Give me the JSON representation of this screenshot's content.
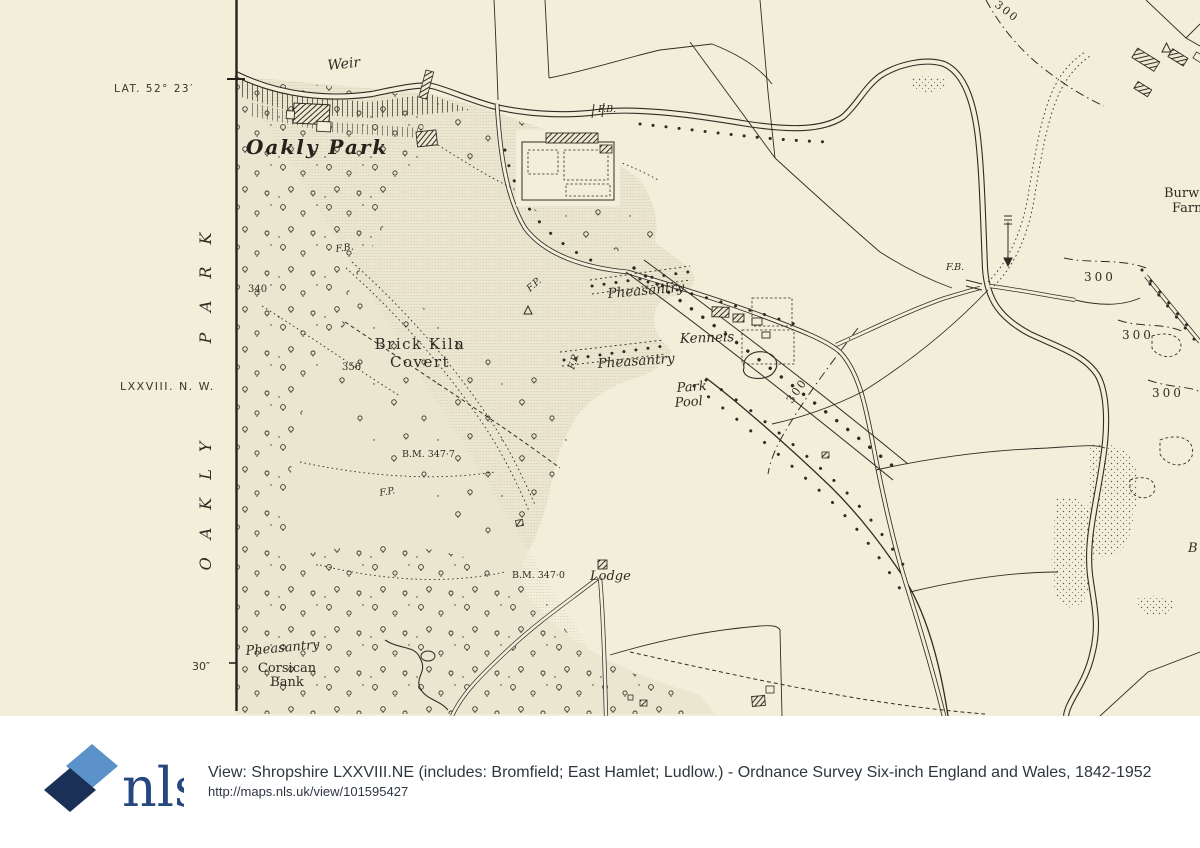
{
  "colors": {
    "paper": "#f3eeda",
    "park_tint": "#ebe6d0",
    "ink": "#302c24",
    "footer_text": "#2e3640",
    "logo_light_blue": "#5b92c9",
    "logo_dark_navy": "#1b3057",
    "logo_text_navy": "#27477f"
  },
  "map": {
    "margin": {
      "lat": "LAT. 52° 23′",
      "sheet": "LXXVIII. N. W.",
      "vertical_top": "PARK",
      "vertical_bottom": "OAKLY",
      "seconds": "30″"
    },
    "labels": {
      "weir": "Weir",
      "oakly_park": "Oakly Park",
      "fb_top": "F.B.",
      "fb_park": "F.B.",
      "h340": "340",
      "h356": "356",
      "brick_kiln": "Brick Kiln",
      "covert": "Covert",
      "fp1": "F.P.",
      "pheasantry1": "Pheasantry",
      "kennels": "Kennels",
      "pheasantry2": "Pheasantry",
      "fp2": "F.P.",
      "park": "Park",
      "pool": "Pool",
      "bm3477": "B.M. 347·7",
      "fp3": "F.P.",
      "bm3470": "B.M. 347·0",
      "lodge": "Lodge",
      "pheasantry3": "Pheasantry",
      "corsican": "Corsican",
      "bank": "Bank",
      "fb_right": "F.B.",
      "c300_1": "300",
      "c300_2": "300",
      "c300_3": "300",
      "c300_contour": "300",
      "c300_top": "300",
      "burway": "Burw",
      "farm": "Farm",
      "b_edge": "B"
    }
  },
  "footer": {
    "logo_text": "nls",
    "title": "View: Shropshire LXXVIII.NE (includes: Bromfield; East Hamlet; Ludlow.) - Ordnance Survey Six-inch England and Wales, 1842-1952",
    "url": "http://maps.nls.uk/view/101595427"
  }
}
